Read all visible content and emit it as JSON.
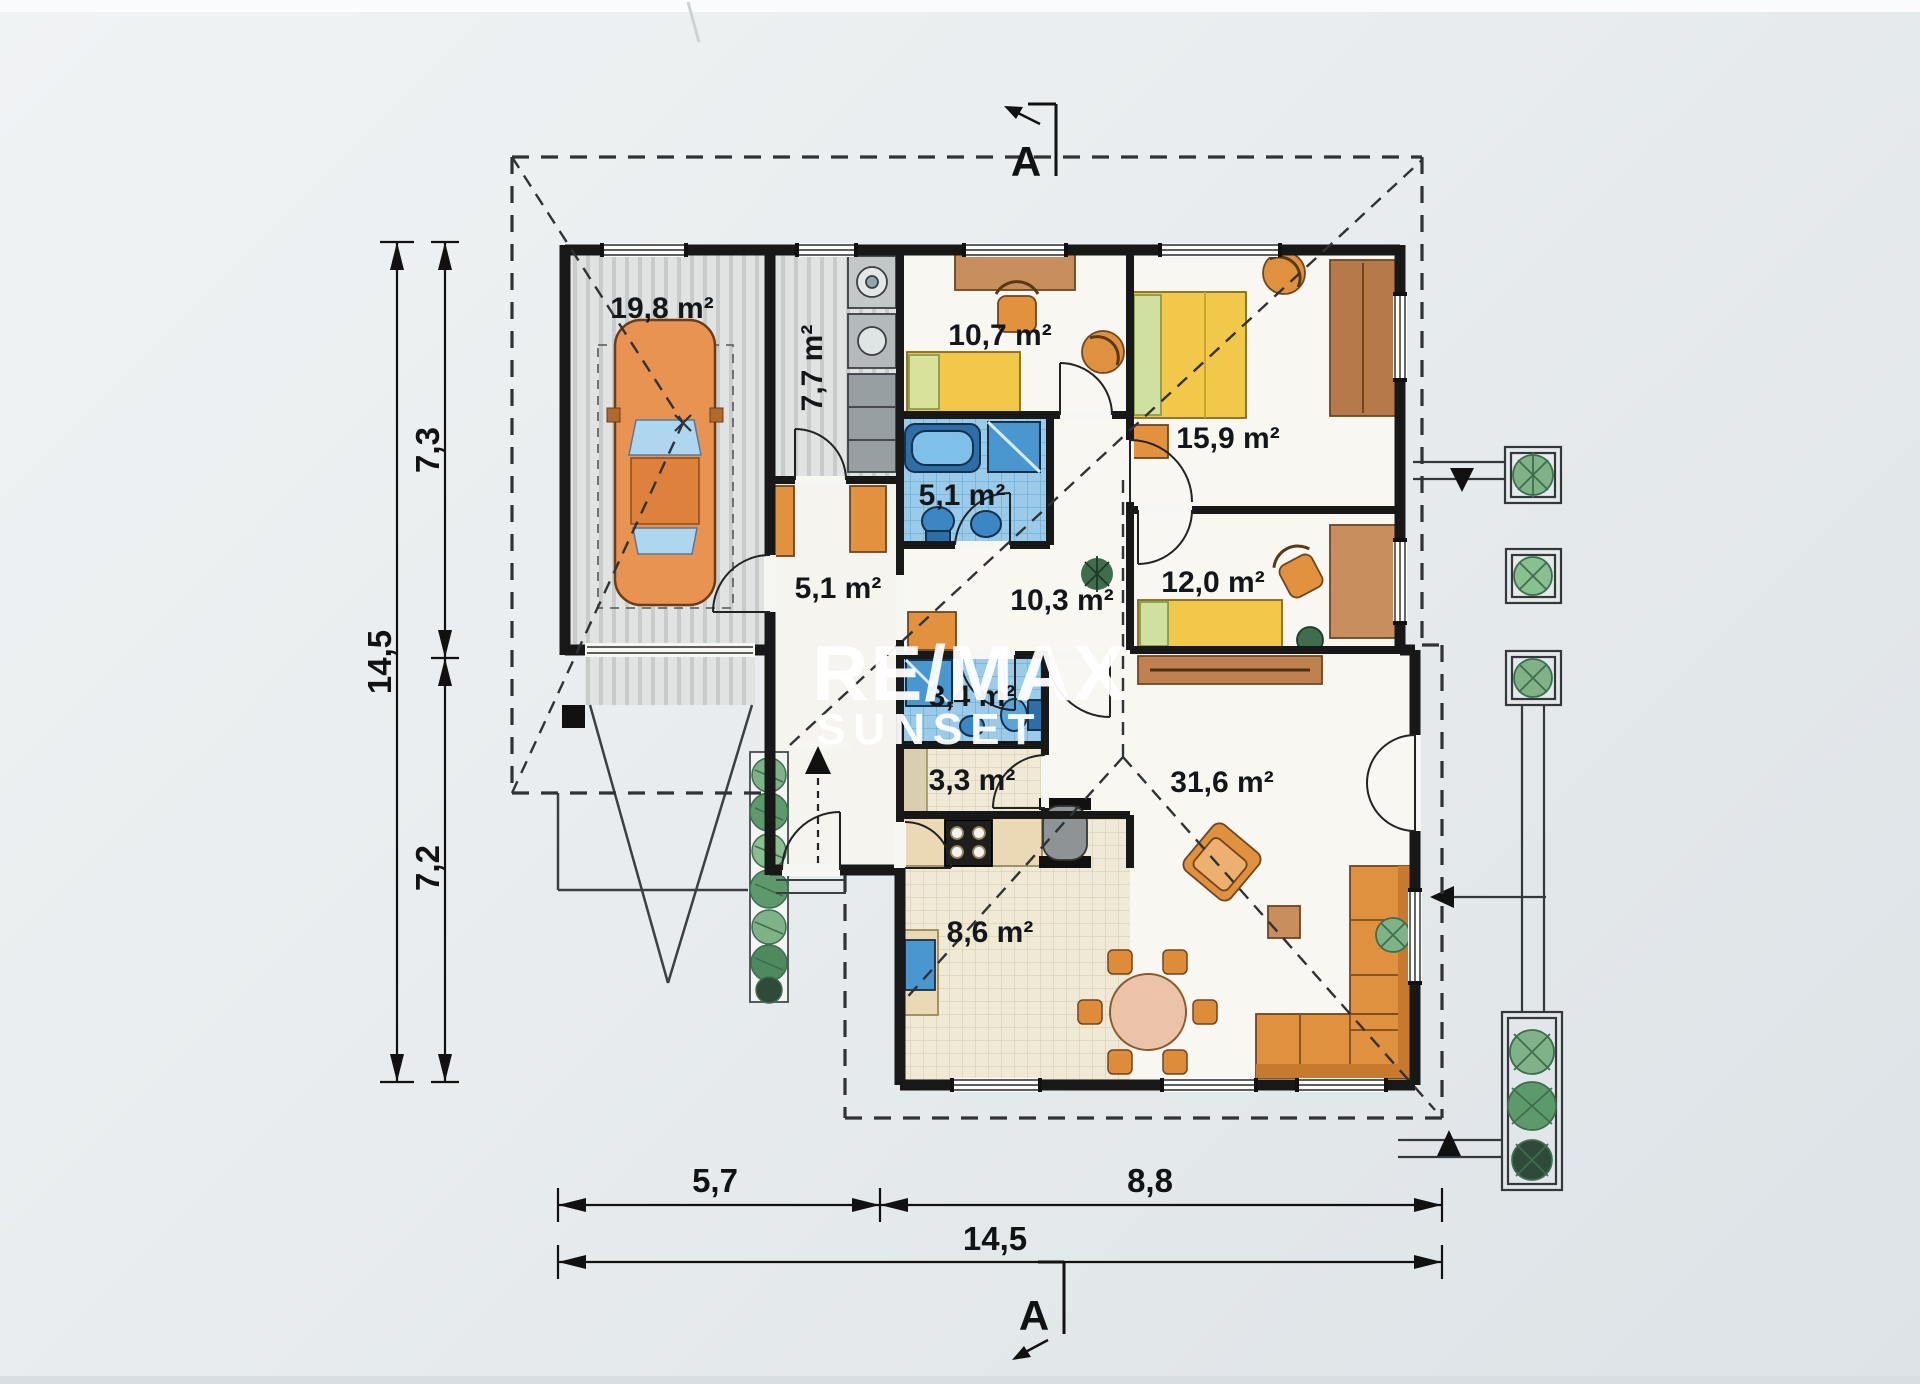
{
  "watermark": {
    "line1": "RE/MAX",
    "line2": "SUNSET"
  },
  "section": {
    "top": "A",
    "bottom": "A"
  },
  "rooms": {
    "garage": "19,8 m²",
    "utility": "7,7 m²",
    "child_room": "10,7 m²",
    "bedroom": "15,9 m²",
    "bathroom": "5,1 m²",
    "entry_hall": "5,1 m²",
    "hall": "10,3 m²",
    "study": "12,0 m²",
    "wc": "3,4 m²",
    "pantry": "3,3 m²",
    "kitchen": "8,6 m²",
    "living_room": "31,6 m²"
  },
  "dimensions": {
    "left_total": "14,5",
    "left_upper": "7,3",
    "left_lower": "7,2",
    "bottom_left": "5,7",
    "bottom_right": "8,8",
    "bottom_total": "14,5"
  },
  "colors": {
    "paper": "#e9edef",
    "wall": "#181818",
    "furniture_orange": "#e0913f",
    "bed_yellow": "#f2c84b",
    "sanitary_blue": "#4a97cf",
    "tile_blue": "#9bcbe9",
    "tile_beige": "#efe9d6",
    "plant_green": "#7fb387",
    "watermark_white": "#ffffff"
  }
}
